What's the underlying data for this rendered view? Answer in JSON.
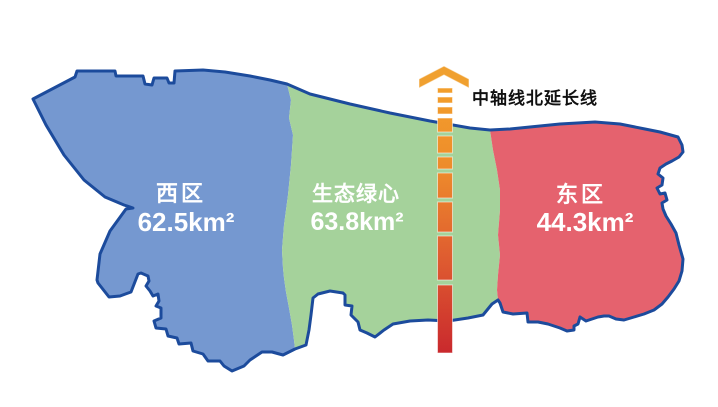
{
  "map": {
    "title": "三区规划示意图",
    "regions": [
      {
        "id": "west",
        "name": "西区",
        "area": "62.5km²",
        "fill": "#7598D0"
      },
      {
        "id": "green-heart",
        "name": "生态绿心",
        "area": "63.8km²",
        "fill": "#A5D29B"
      },
      {
        "id": "east",
        "name": "东区",
        "area": "44.3km²",
        "fill": "#E5626E"
      }
    ],
    "outline_color": "#1C4B9C",
    "label_color": "#FFFFFF"
  },
  "axis": {
    "label": "中轴线北延长线",
    "label_color": "#111111",
    "arrow_color": "#F0A02F",
    "gradient": [
      "#F4A42C",
      "#EE8C2B",
      "#DE5A30",
      "#C9282D"
    ]
  },
  "background": "#FFFFFF"
}
